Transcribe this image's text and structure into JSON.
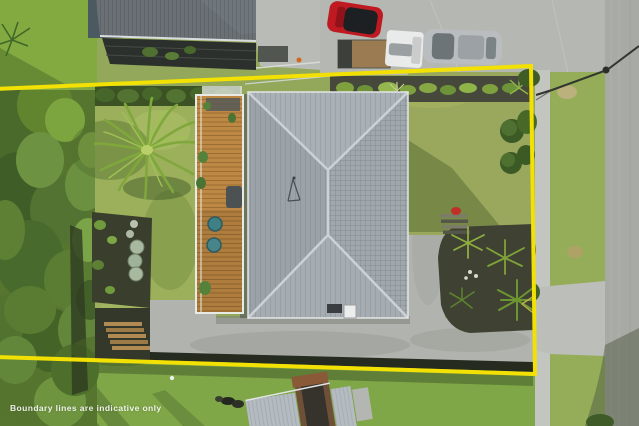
{
  "watermark": {
    "text": "Boundary lines are indicative only"
  },
  "colors": {
    "boundary": "#f3e103",
    "main_roof": "#9ea5ab",
    "neighbor_roof_top": "#6a7075",
    "neighbor_roof_bottom": "#b5bcc1",
    "deck_wood": "#bd8843",
    "lawn": "#93a85a",
    "front_lawn": "#9aa85e",
    "neighbor_lawn": "#7fa647",
    "grass_verge": "#95ad58",
    "vegetation": "#56762f",
    "concrete": "#b5b7b2",
    "footpath": "#c3c5c1",
    "road": "#a8aaa5",
    "mulch": "#3f4233",
    "car_red": "#bf1a22",
    "car_white": "#e9ebea",
    "car_silver": "#b9bdbf",
    "watermark_text": "#ffffff"
  }
}
